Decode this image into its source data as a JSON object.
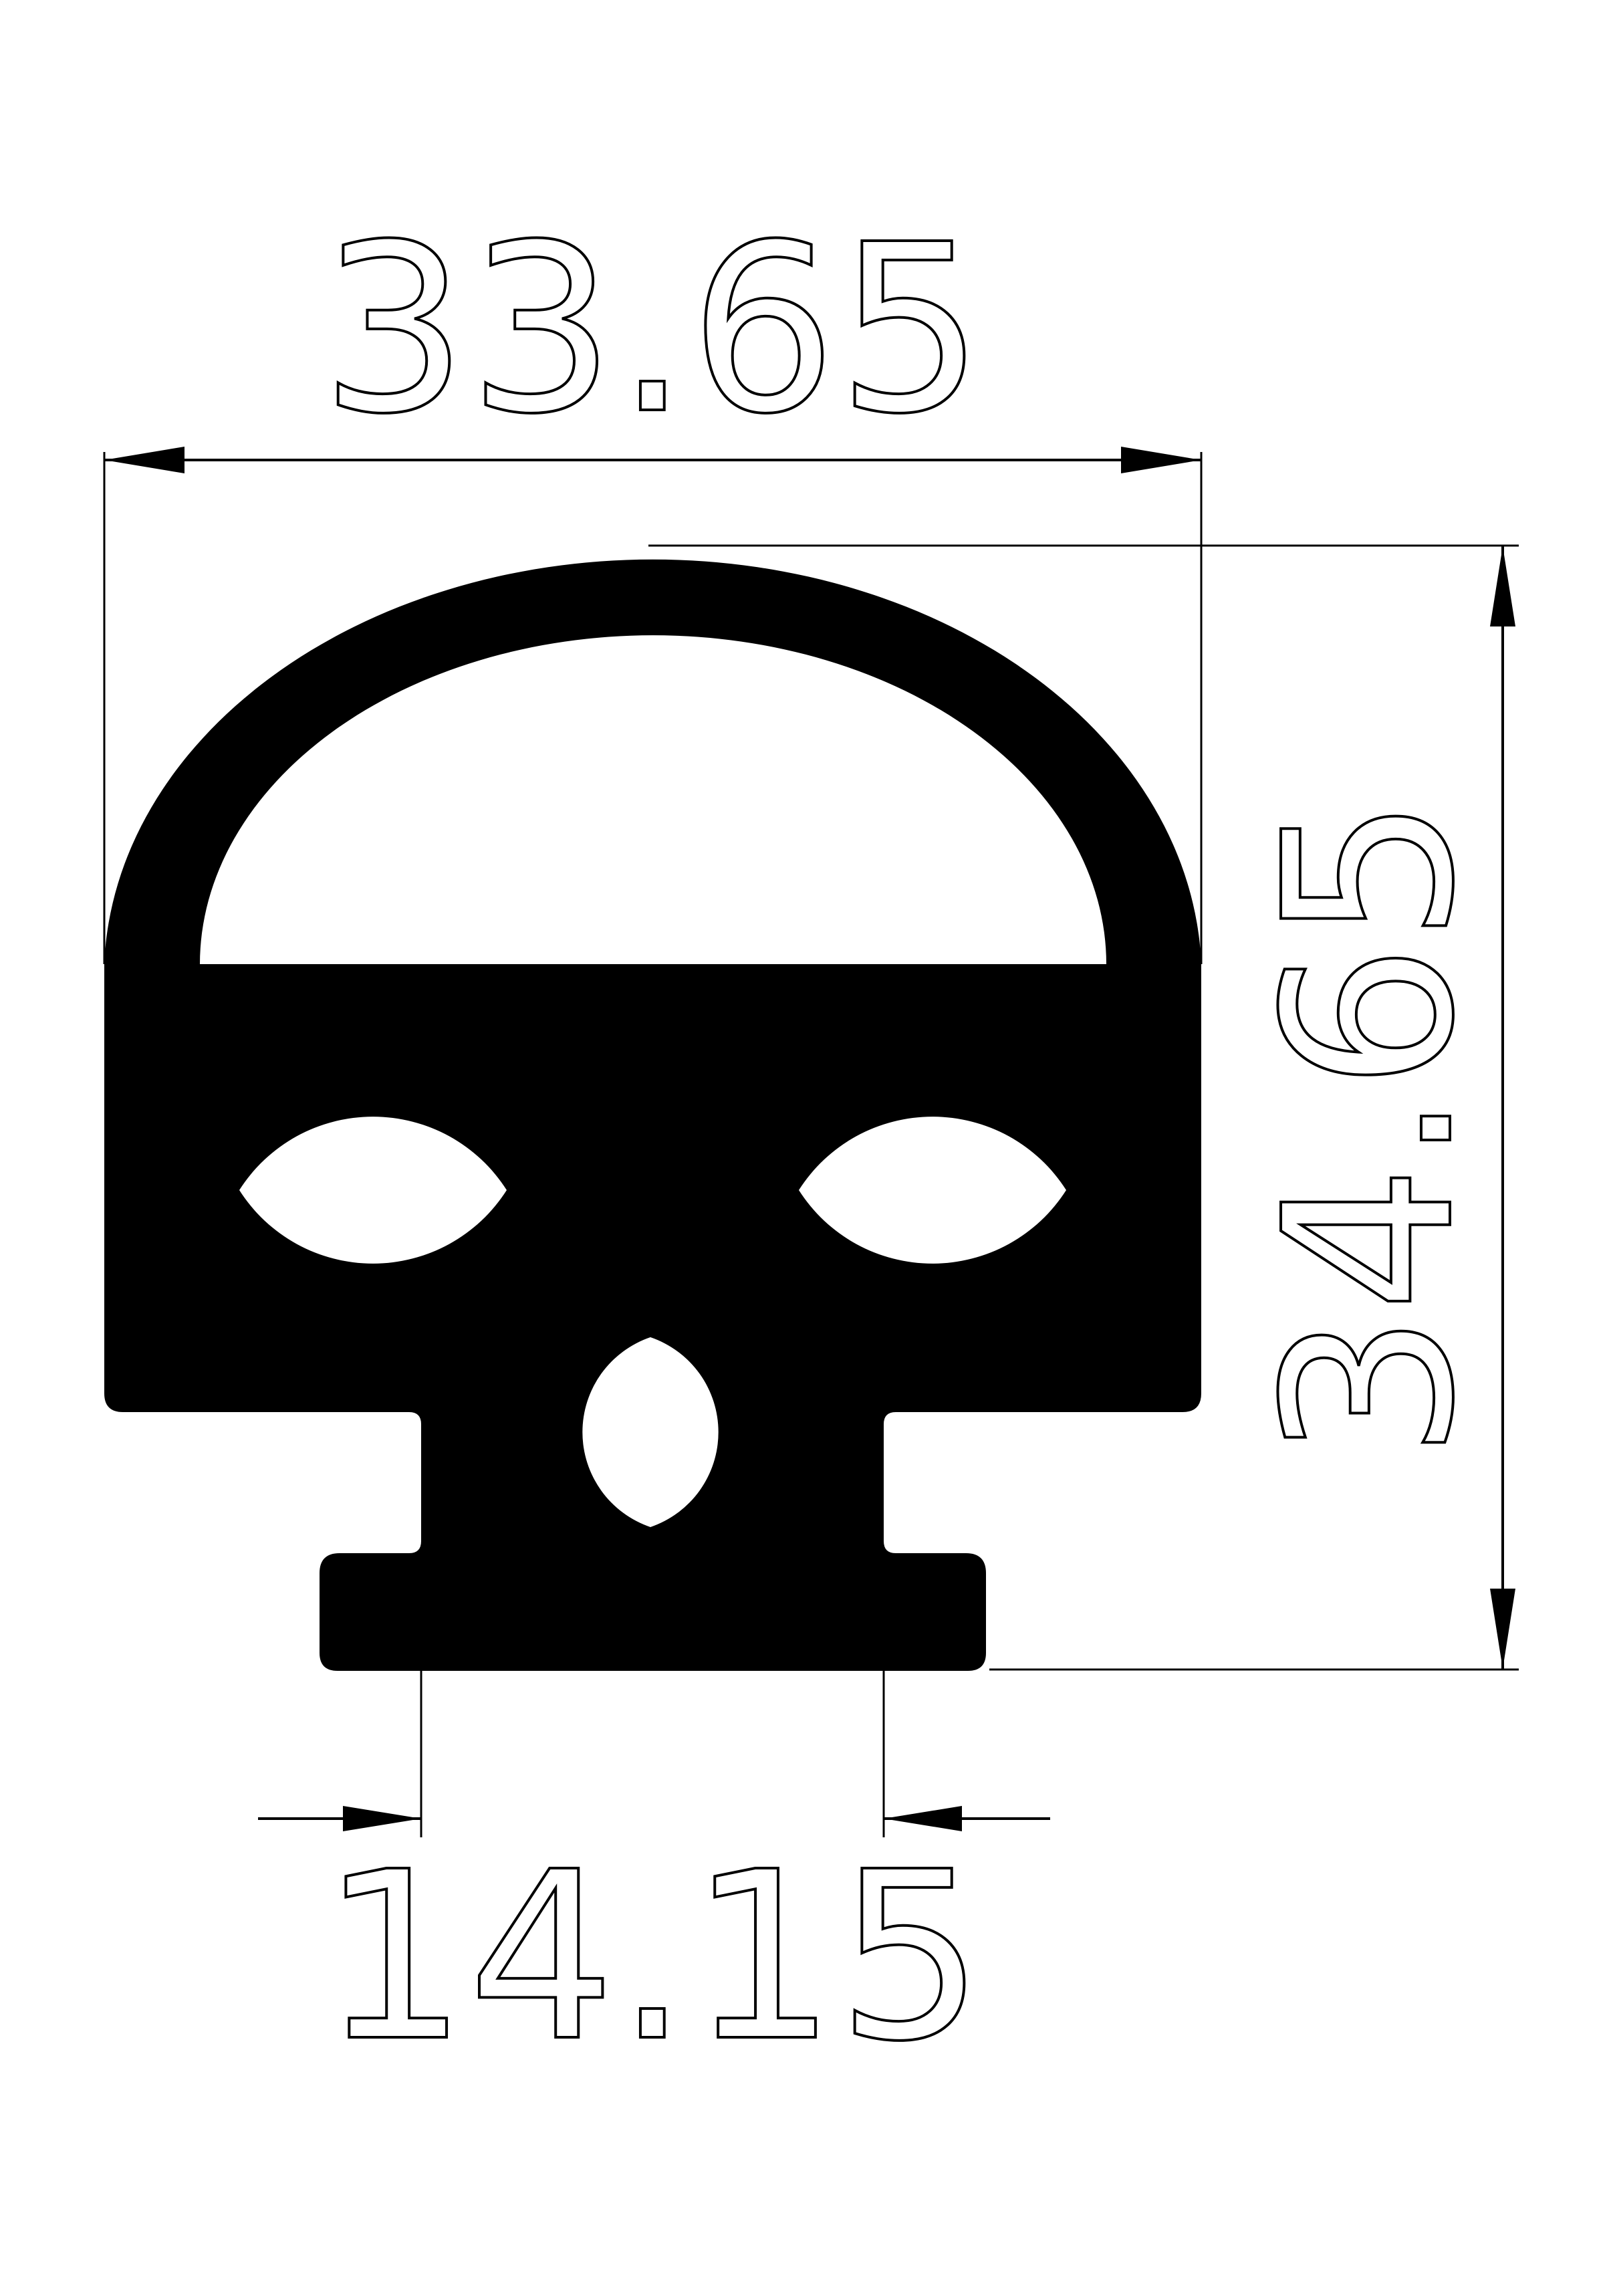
{
  "page": {
    "title": "Seal profile cross-section dimension drawing",
    "paper_color": "#ffffff",
    "ink_color": "#000000"
  },
  "drawing": {
    "type": "technical-dimension-drawing",
    "profile": {
      "name": "rubber-seal-profile-silhouette",
      "fill_color": "#000000",
      "cutouts": [
        "inner-semicircle-window",
        "left-lens-hole",
        "right-lens-hole",
        "center-vertical-lens-hole"
      ]
    },
    "dimensions": {
      "overall_width": {
        "label": "33.65",
        "value": 33.65,
        "orientation": "horizontal",
        "position": "top"
      },
      "overall_height": {
        "label": "34.65",
        "value": 34.65,
        "orientation": "vertical",
        "position": "right"
      },
      "base_width": {
        "label": "14.15",
        "value": 14.15,
        "orientation": "horizontal",
        "position": "bottom"
      }
    }
  }
}
